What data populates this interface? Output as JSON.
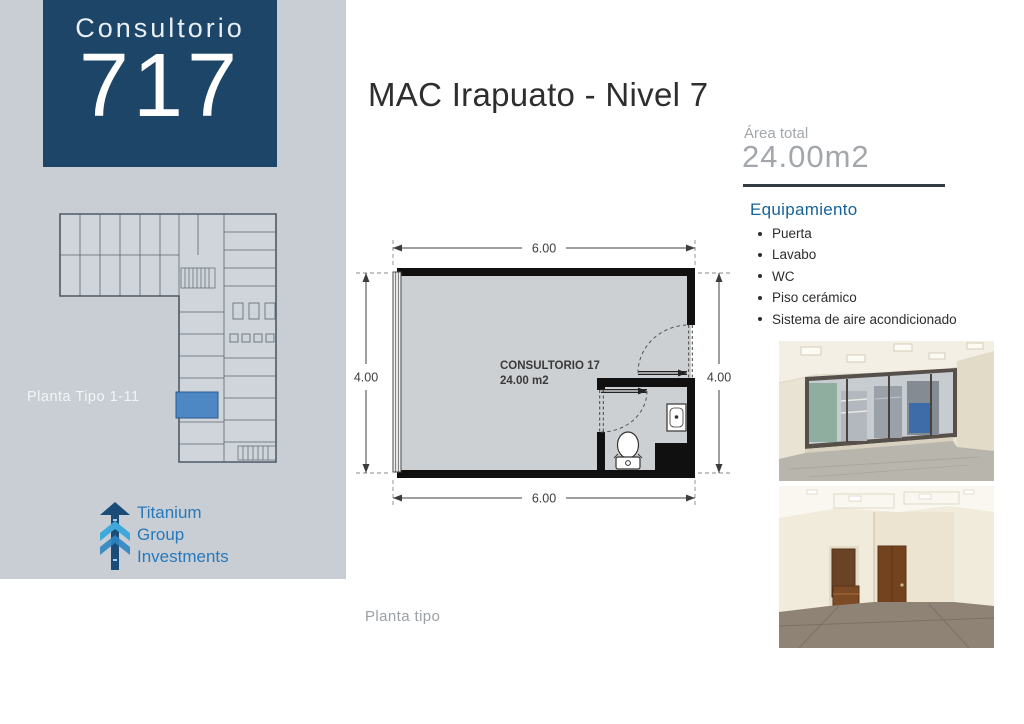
{
  "sidebar": {
    "unit_label": "Consultorio",
    "unit_number": "717",
    "plan_caption": "Planta Tipo 1-11",
    "logo": {
      "line1": "Titanium",
      "line2": "Group",
      "line3": "Investments"
    }
  },
  "header": {
    "title": "MAC Irapuato - Nivel 7"
  },
  "area": {
    "label": "Área total",
    "value": "24.00m2"
  },
  "equipment": {
    "heading": "Equipamiento",
    "items": [
      "Puerta",
      "Lavabo",
      "WC",
      "Piso cerámico",
      "Sistema de aire acondicionado"
    ]
  },
  "floorplan": {
    "room_name": "CONSULTORIO 17",
    "room_area": "24.00 m2",
    "dims": {
      "top": "6.00",
      "bottom": "6.00",
      "left": "4.00",
      "right": "4.00"
    },
    "caption": "Planta tipo"
  },
  "colors": {
    "navy_box": "#1d4568",
    "sidebar_gray": "#c8ced4",
    "heading_blue": "#15639b",
    "muted_gray": "#a3a7ab",
    "logo_blue": "#2779bb",
    "highlight_room_blue": "#4d87c4",
    "divider_dark": "#333c44"
  }
}
